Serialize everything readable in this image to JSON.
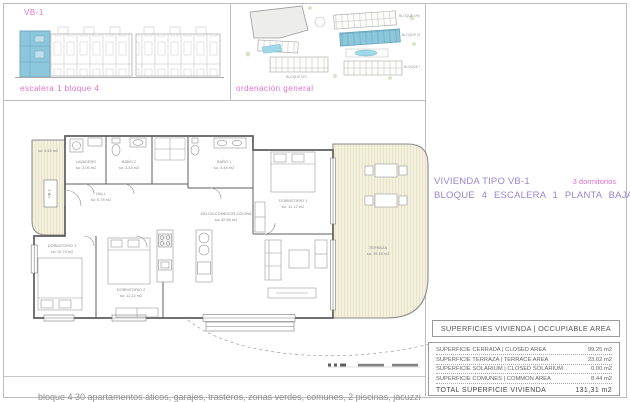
{
  "header": {
    "unit_code": "VB-1",
    "elevation_caption": "escalera 1 bloque 4",
    "siteplan_caption": "ordenación general",
    "siteplan_block_labels": [
      "BLOQUE Nº5",
      "BLOQUE Nº4",
      "BLOQUE Nº3",
      "BLOQUE Nº2"
    ]
  },
  "title_block": {
    "name": "VIVIENDA TIPO VB-1",
    "bedrooms": "3 dormitorios",
    "location": "BLOQUE 4  ESCALERA 1  PLANTA BAJA"
  },
  "plan": {
    "unit_tag": "VB-1",
    "rooms": [
      {
        "area": "su: 4.44 m2"
      },
      {
        "name": "LAVADERO",
        "area": "su: 3.05 m2"
      },
      {
        "name": "BAÑO 2",
        "area": "su: 3.83 m2"
      },
      {
        "name": "BAÑO 1",
        "area": "su: 4.48 m2"
      },
      {
        "name": "HALL",
        "area": "su: 5.78 m2"
      },
      {
        "name": "DORMITORIO 1",
        "area": "su: 12.12 m2"
      },
      {
        "name": "DORMITORIO 3",
        "area": "su: 10.79 m2"
      },
      {
        "name": "DORMITORIO 2",
        "area": "su: 11.12 m2"
      },
      {
        "name": "SALON-COMEDOR-COCINA",
        "area": "su: 32.86 m2"
      },
      {
        "name": "TERRAZA",
        "area": "su: 19.18 m2"
      }
    ]
  },
  "areas_table": {
    "header": "SUPERFICIES VIVIENDA | OCCUPIABLE AREA",
    "rows": [
      {
        "label": "SUPERFICIE CERRADA   |  CLOSED AREA",
        "value": "99.25 m2"
      },
      {
        "label": "SUPERFICIE TERRAZA   |  TERRACE AREA",
        "value": "23.62 m2"
      },
      {
        "label": "SUPERFICIE SOLARIUM |  CLOSED SOLARIUM",
        "value": "0.00 m2"
      },
      {
        "label": "SUPERFICIE COMUNES |  COMMON AREA",
        "value": "8.44 m2"
      }
    ],
    "total_label": "TOTAL SUPERFICIE VIVIENDA",
    "total_value": "131,31  m2"
  },
  "footer": {
    "note": "bloque 4 30 apartamentos áticos, garajes, trasteros, zonas verdes, comunes, 2 piscinas, jacuzzi"
  },
  "colors": {
    "magenta": "#e071cb",
    "purple": "#9c84d0",
    "highlight_blue": "#8cc7dc",
    "terrace_fill": "#f3f0dd"
  }
}
